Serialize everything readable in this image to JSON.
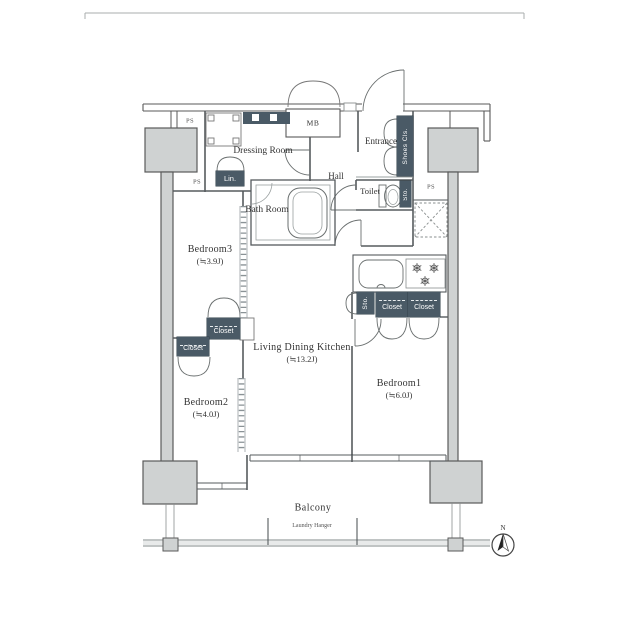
{
  "floorplan": {
    "rooms": {
      "dressing_room": {
        "name": "Dressing Room"
      },
      "bath_room": {
        "name": "Bath Room"
      },
      "hall": {
        "name": "Hall"
      },
      "entrance": {
        "name": "Entrance"
      },
      "toilet": {
        "name": "Toilet"
      },
      "living_dining_kitchen": {
        "name": "Living Dining Kitchen",
        "size": "(≒13.2J)"
      },
      "bedroom1": {
        "name": "Bedroom1",
        "size": "(≒6.0J)"
      },
      "bedroom2": {
        "name": "Bedroom2",
        "size": "(≒4.0J)"
      },
      "bedroom3": {
        "name": "Bedroom3",
        "size": "(≒3.9J)"
      },
      "balcony": {
        "name": "Balcony"
      }
    },
    "labels": {
      "ps": "PS",
      "mb": "MB",
      "linen": "Lin.",
      "shoes_closet": "Shoes Cls.",
      "storage": "Sto.",
      "closet": "Closet",
      "laundry_hanger": "Laundry Hanger",
      "north": "N"
    },
    "colors": {
      "badge": "#4a5a66",
      "column_fill": "#cfd2d2",
      "wall_line": "#5a5a5a"
    }
  }
}
